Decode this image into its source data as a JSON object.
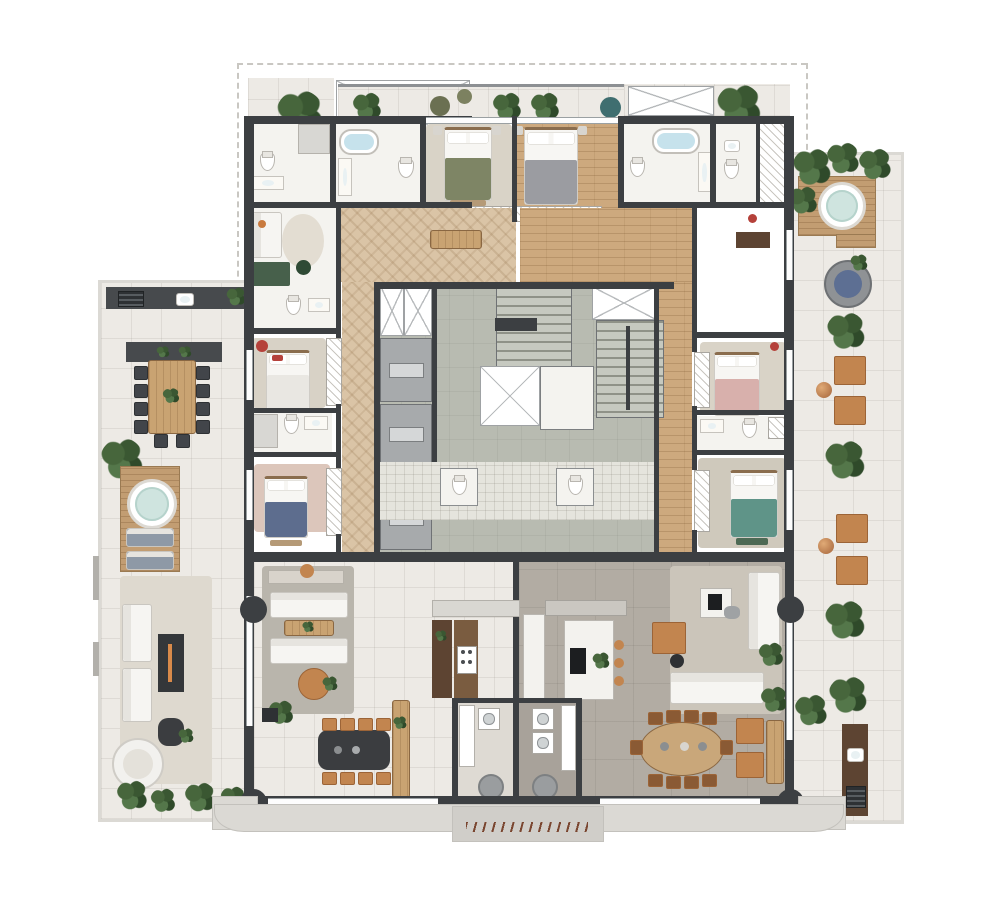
{
  "document": {
    "kind": "architectural floor plan rendering",
    "description": "Top-view color floor plan of a residential tower floor with two apartment units, central elevator-and-stair core, wrap-around terraces with hot tubs, outdoor dining and lounges. No text labels are rendered in the image.",
    "units_visible": 2,
    "text_labels": []
  },
  "palette": {
    "wall": "#3c3f42",
    "tile": "#edeae5",
    "ledge": "#dbd9d4",
    "woodLight": "#dac4a6",
    "woodMid": "#cda97e",
    "deckWood": "#c29d72",
    "concrete": "#b8bbb1",
    "greige": "#b2aca3",
    "water": "#cfe4df",
    "bathWater": "#c6e2ec",
    "leather": "#c2854f",
    "copper": "#c08552",
    "plantGreen": "#47663c",
    "duvetGreen": "#7e8565",
    "duvetGray": "#9b9ca1",
    "duvetBlue": "#5d6d8e",
    "duvetPink": "#d8b0ac",
    "duvetTeal": "#5f9488",
    "accentRed": "#b5413a",
    "accentOrange": "#d98a4a"
  },
  "features": {
    "terraces": [
      "left terrace with outdoor kitchen, dining table for 10, hot tub deck with loungers, lounge with fire table and daybed",
      "right terrace with hot tub deck, round daybed, armchair pairs with copper side tables, barbecue counter",
      "top balcony strip with poufs and planters"
    ],
    "core": [
      "two ventilation shafts",
      "three elevators",
      "two staircases",
      "service corridor with two lavatories"
    ],
    "unit_left": [
      "master suite with green bed",
      "second suite with gray bed",
      "two bedrooms (white/red and blue beds)",
      "three bathrooms with oval tub",
      "study nook",
      "herringbone wood hall",
      "living-dining room",
      "kitchen with wine pantry",
      "laundry room"
    ],
    "unit_right": [
      "suite with pink bed",
      "suite with teal bed",
      "master bath with oval tub and walk-in closet",
      "plank wood hall",
      "living room with leather armchairs",
      "oval 10-seat dining table",
      "marble island kitchen",
      "laundry room"
    ],
    "counts": {
      "hot_tubs": 3,
      "elevators": 3,
      "stairs": 2,
      "columns": 4,
      "beds": 6,
      "plants_approx": 24
    }
  }
}
